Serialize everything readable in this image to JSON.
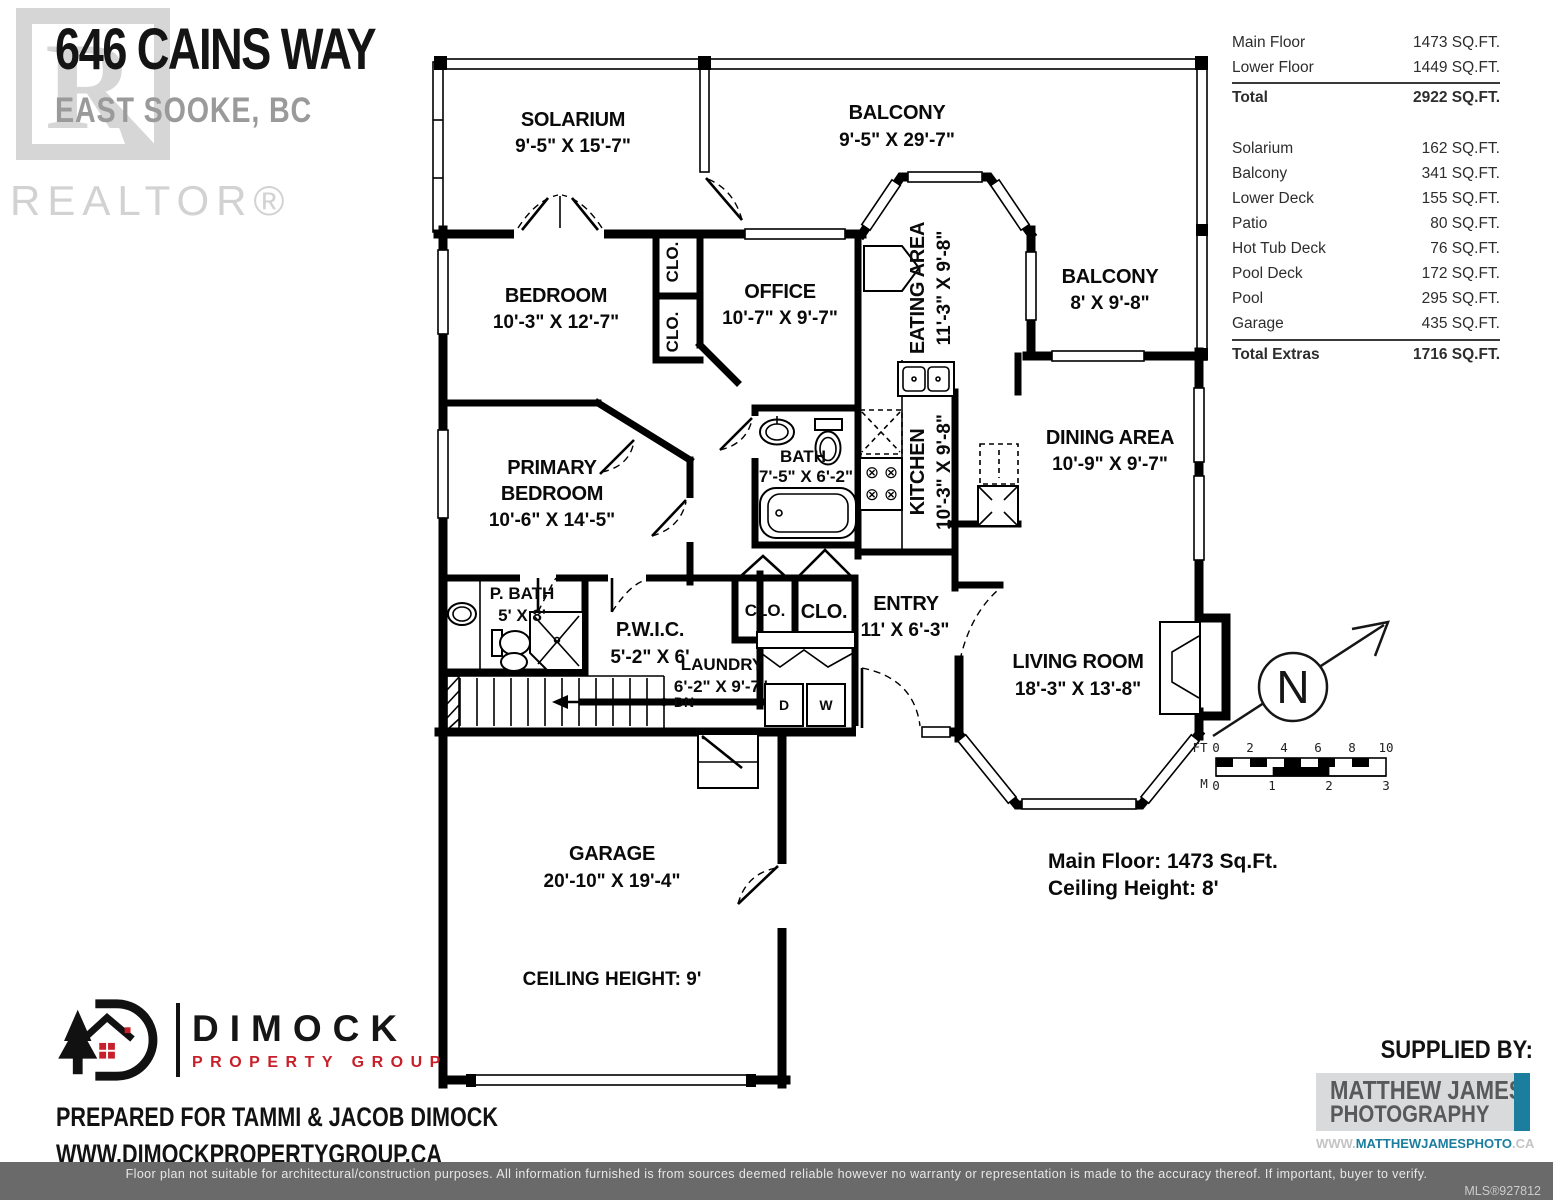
{
  "header": {
    "title": "646 CAINS WAY",
    "subtitle": "EAST SOOKE, BC",
    "watermark_letter": "R",
    "watermark_text": "REALTOR®"
  },
  "area_table": {
    "main_rows": [
      {
        "label": "Main Floor",
        "value": "1473 SQ.FT."
      },
      {
        "label": "Lower Floor",
        "value": "1449 SQ.FT."
      }
    ],
    "main_total": {
      "label": "Total",
      "value": "2922 SQ.FT."
    },
    "extras_rows": [
      {
        "label": "Solarium",
        "value": "162 SQ.FT."
      },
      {
        "label": "Balcony",
        "value": "341 SQ.FT."
      },
      {
        "label": "Lower Deck",
        "value": "155 SQ.FT."
      },
      {
        "label": "Patio",
        "value": "80 SQ.FT."
      },
      {
        "label": "Hot Tub Deck",
        "value": "76 SQ.FT."
      },
      {
        "label": "Pool Deck",
        "value": "172 SQ.FT."
      },
      {
        "label": "Pool",
        "value": "295 SQ.FT."
      },
      {
        "label": "Garage",
        "value": "435 SQ.FT."
      }
    ],
    "extras_total": {
      "label": "Total Extras",
      "value": "1716 SQ.FT."
    }
  },
  "plan": {
    "rooms": {
      "solarium_name": "SOLARIUM",
      "solarium_dims": "9'-5\" X 15'-7\"",
      "balcony_top_name": "BALCONY",
      "balcony_top_dims": "9'-5\" X 29'-7\"",
      "balcony_right_name": "BALCONY",
      "balcony_right_dims": "8' X 9'-8\"",
      "bedroom_name": "BEDROOM",
      "bedroom_dims": "10'-3\" X 12'-7\"",
      "office_name": "OFFICE",
      "office_dims": "10'-7\" X 9'-7\"",
      "eating_name": "EATING AREA",
      "eating_dims": "11'-3\" X 9'-8\"",
      "dining_name": "DINING AREA",
      "dining_dims": "10'-9\" X 9'-7\"",
      "primary_l1": "PRIMARY",
      "primary_l2": "BEDROOM",
      "primary_dims": "10'-6\" X 14'-5\"",
      "bath_name": "BATH",
      "bath_dims": "7'-5\" X 6'-2\"",
      "kitchen_name": "KITCHEN",
      "kitchen_dims": "10'-3\" X 9'-8\"",
      "pbath_name": "P. BATH",
      "pbath_dims": "5' X 8'",
      "pwic_name": "P.W.I.C.",
      "pwic_dims": "5'-2\" X 6'",
      "laundry_name": "LAUNDRY",
      "laundry_dims": "6'-2\" X 9'-7\"",
      "entry_name": "ENTRY",
      "entry_dims": "11' X 6'-3\"",
      "living_name": "LIVING ROOM",
      "living_dims": "18'-3\" X 13'-8\"",
      "garage_name": "GARAGE",
      "garage_dims": "20'-10\" X 19'-4\"",
      "closet": "CLO."
    },
    "labels": {
      "garage_ceiling": "CEILING HEIGHT: 9'",
      "down": "DN",
      "dryer": "D",
      "washer": "W",
      "note_line1": "Main Floor: 1473 Sq.Ft.",
      "note_line2": "Ceiling Height: 8'",
      "north": "N"
    },
    "scale": {
      "ft": "FT",
      "m": "M",
      "ft_ticks": [
        "0",
        "2",
        "4",
        "6",
        "8",
        "10"
      ],
      "m_ticks": [
        "0",
        "1",
        "2",
        "3"
      ]
    }
  },
  "branding": {
    "dimock": {
      "name": "DIMOCK",
      "tagline": "PROPERTY GROUP",
      "prepared_for": "PREPARED FOR TAMMI & JACOB DIMOCK",
      "website": "WWW.DIMOCKPROPERTYGROUP.CA",
      "red": "#c8202a"
    },
    "supplier": {
      "heading": "SUPPLIED BY:",
      "line1": "MATTHEW JAMES",
      "line2": "PHOTOGRAPHY",
      "url_prefix": "WWW.",
      "url_main": "MATTHEWJAMESPHOTO",
      "url_suffix": ".CA",
      "teal": "#1b7e9e"
    }
  },
  "footer": {
    "disclaimer": "Floor plan not suitable for architectural/construction purposes. All information furnished is from sources deemed reliable however no warranty or representation is made to the accuracy thereof. If important, buyer to verify.",
    "mls": "MLS®927812"
  }
}
